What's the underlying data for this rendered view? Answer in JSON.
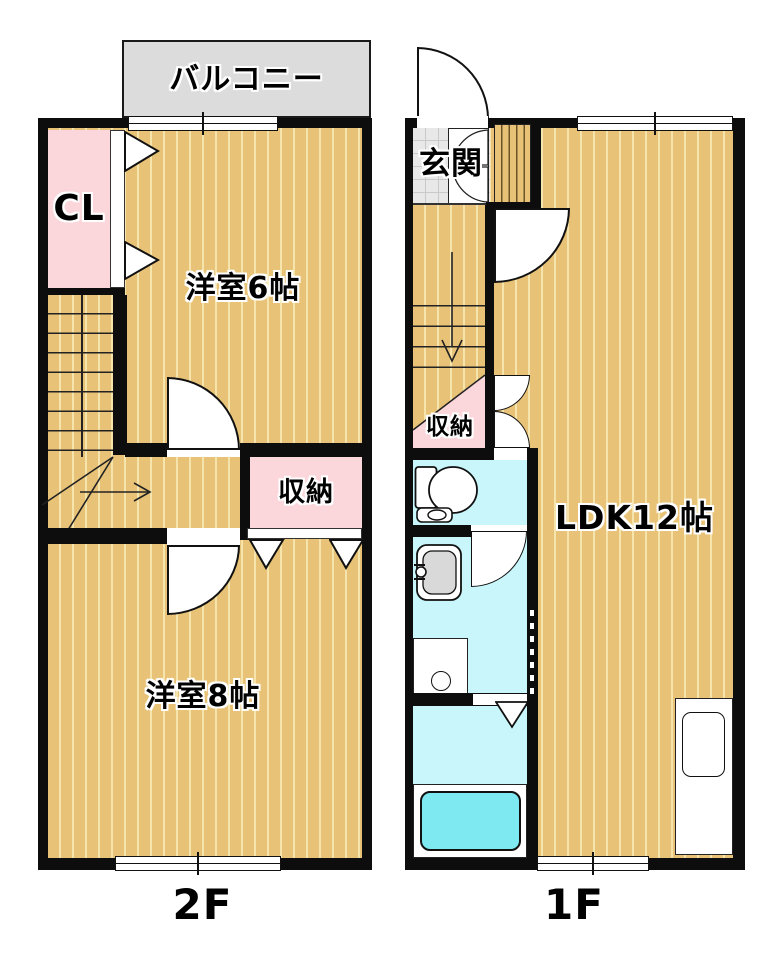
{
  "floor2": {
    "label": "2F",
    "balcony": "バルコニー",
    "closet": "CL",
    "room6": "洋室6帖",
    "storage": "収納",
    "room8": "洋室8帖"
  },
  "floor1": {
    "label": "1F",
    "entrance": "玄関",
    "storage": "収納",
    "ldk": "LDK12帖"
  },
  "icons": [
    "toilet-icon",
    "washbasin-icon",
    "bathtub",
    "washing-machine-pan",
    "kitchen-sink",
    "door-swing",
    "folding-door",
    "closet-door-triangle",
    "stair-up-arrow",
    "stair-down-arrow",
    "window-symbol"
  ],
  "colors": {
    "wall": "#0d0d0d",
    "floor": "#e8c377",
    "floor_stripe": "#f5e5ad",
    "pink": "#fbd6da",
    "cyan": "#c9f6fa",
    "tub": "#7ee9f0",
    "balcony": "#dcdcdc",
    "entrance": "#e8e8e8"
  }
}
